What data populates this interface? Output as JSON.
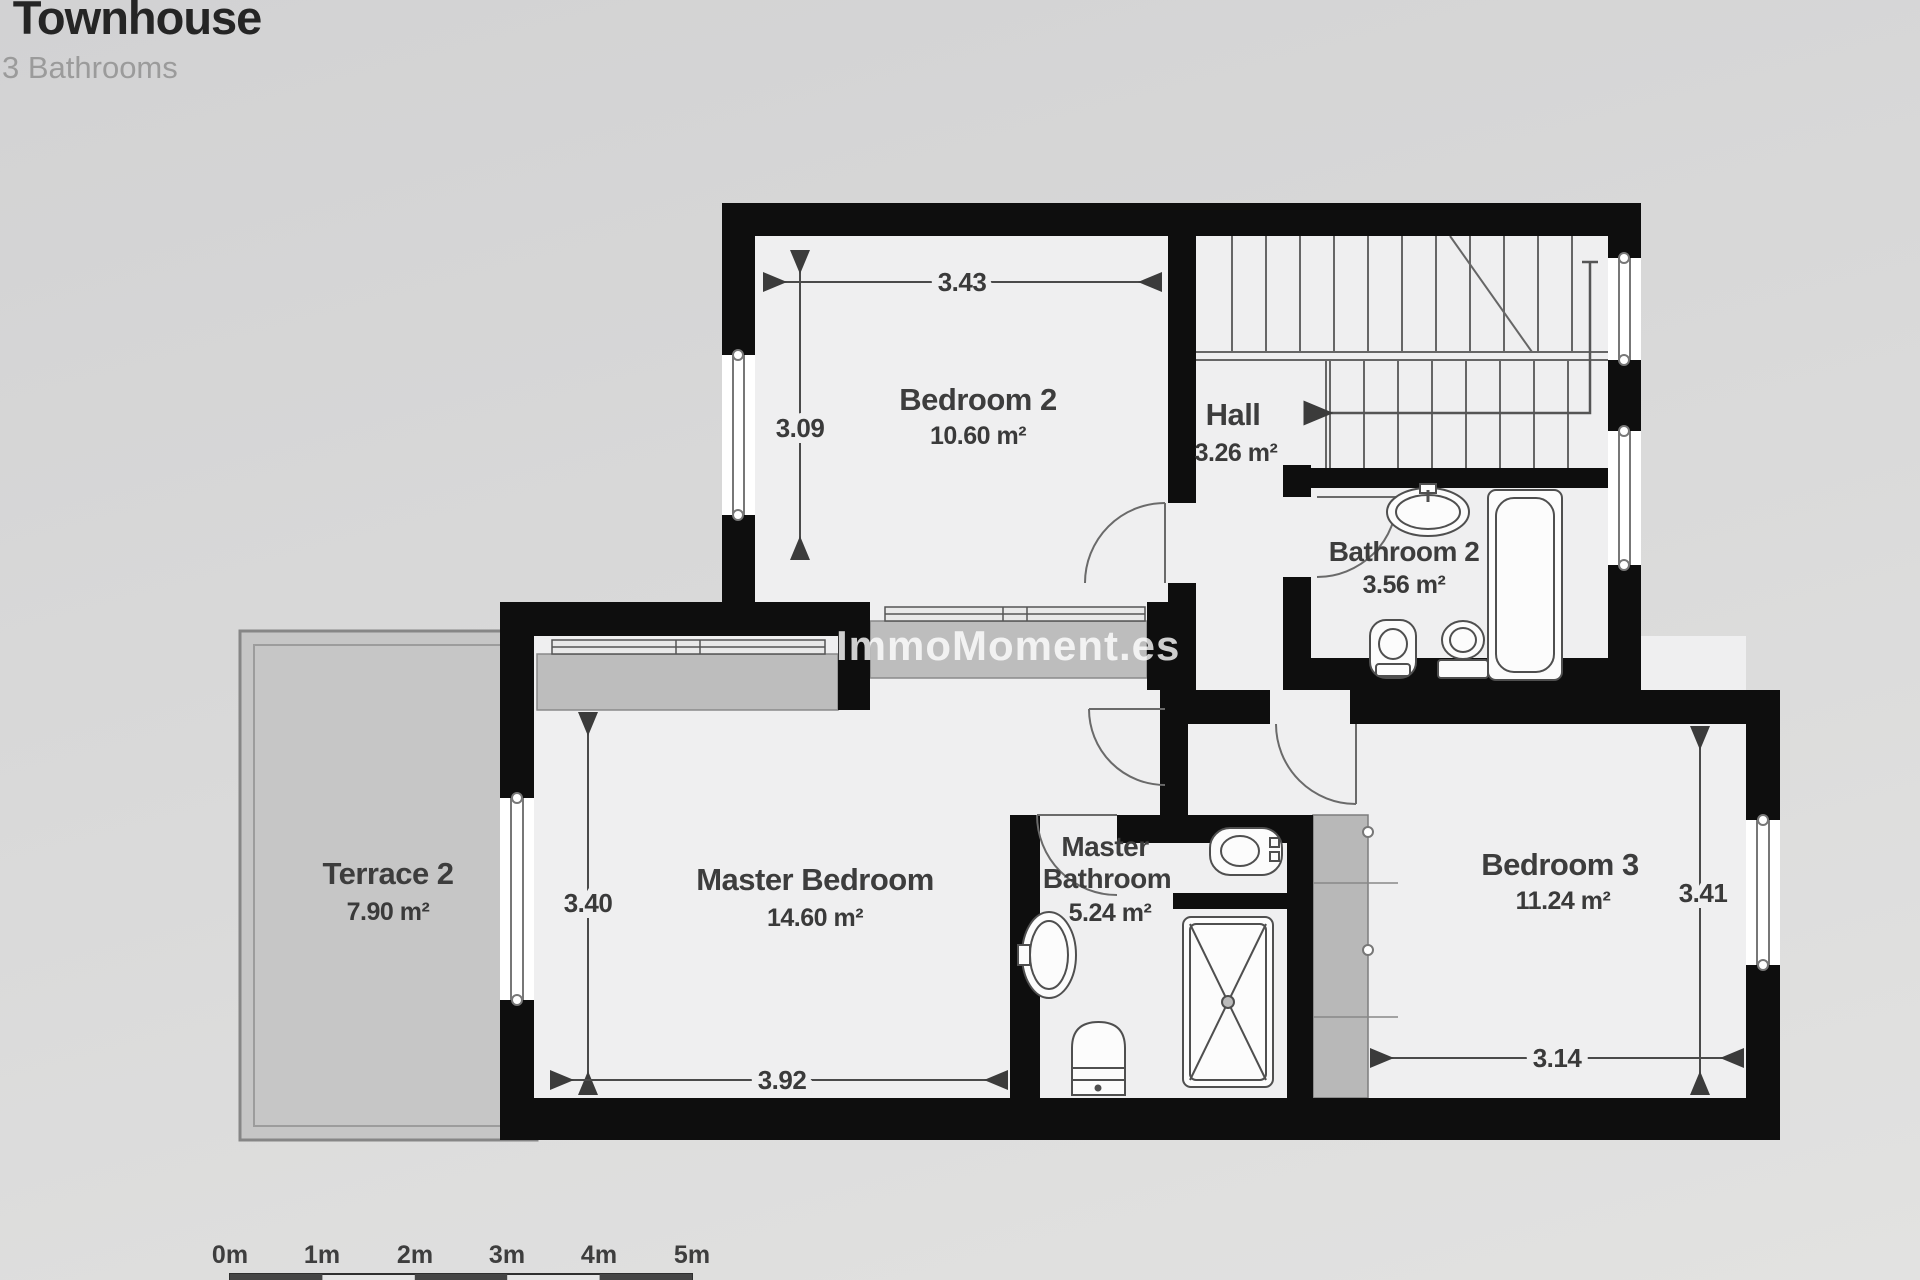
{
  "header": {
    "title": "- Townhouse",
    "subtitle": "3 Bathrooms"
  },
  "watermark": "ImmoMoment.es",
  "rooms": {
    "bedroom2": {
      "name": "Bedroom 2",
      "area": "10.60 m²"
    },
    "hall": {
      "name": "Hall",
      "area": "3.26 m²"
    },
    "bathroom2": {
      "name": "Bathroom 2",
      "area": "3.56 m²"
    },
    "terrace2": {
      "name": "Terrace 2",
      "area": "7.90 m²"
    },
    "master_bedroom": {
      "name": "Master Bedroom",
      "area": "14.60 m²"
    },
    "master_bathroom": {
      "name_line1": "Master",
      "name_line2": "Bathroom",
      "area": "5.24 m²"
    },
    "bedroom3": {
      "name": "Bedroom 3",
      "area": "11.24 m²"
    }
  },
  "dimensions": {
    "bedroom2_width": "3.43",
    "bedroom2_depth": "3.09",
    "master_bedroom_depth": "3.40",
    "master_bedroom_width": "3.92",
    "bedroom3_depth": "3.41",
    "bedroom3_width": "3.14"
  },
  "scale": {
    "labels": [
      "0m",
      "1m",
      "2m",
      "3m",
      "4m",
      "5m"
    ]
  },
  "colors": {
    "wall": "#0e0e0e",
    "floor": "#efeff0",
    "terrace_fill": "#c6c6c6",
    "closet_fill": "#bdbdbd",
    "background": "#d9d9d9"
  }
}
